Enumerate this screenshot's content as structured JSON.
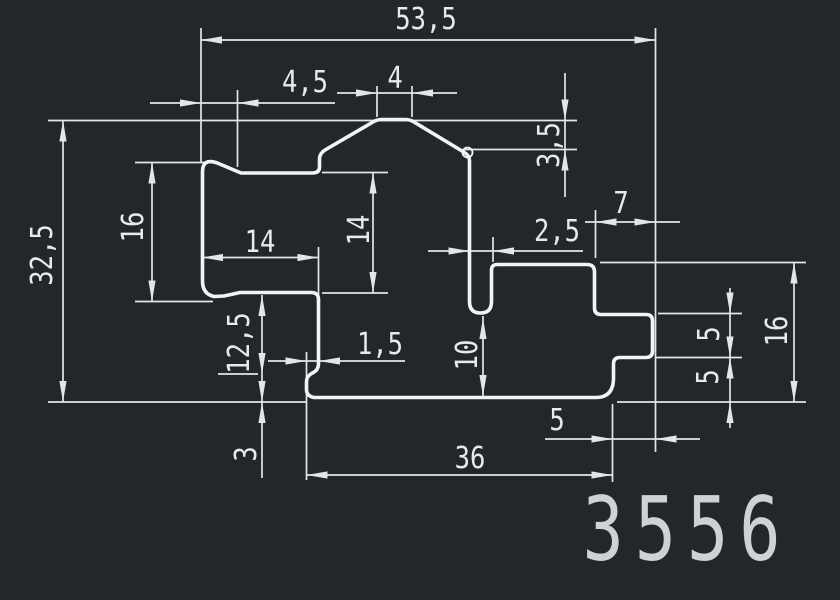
{
  "drawing": {
    "part_number": "3556",
    "dims": {
      "d53_5": "53,5",
      "d4_5": "4,5",
      "d4": "4",
      "d3_5": "3,5",
      "d32_5": "32,5",
      "d16_left": "16",
      "d14_width": "14",
      "d14_height": "14",
      "d2_5": "2,5",
      "d7": "7",
      "d12_5": "12,5",
      "d1_5": "1,5",
      "d10": "10",
      "d5_right_upper": "5",
      "d5_right_lower": "5",
      "d16_right": "16",
      "d3": "3",
      "d5_bottom": "5",
      "d36": "36"
    }
  },
  "colors": {
    "background": "#23262b",
    "profile_line": "#f1f4f5",
    "dim_line": "#e2e6e8",
    "text": "#e6eaec"
  }
}
